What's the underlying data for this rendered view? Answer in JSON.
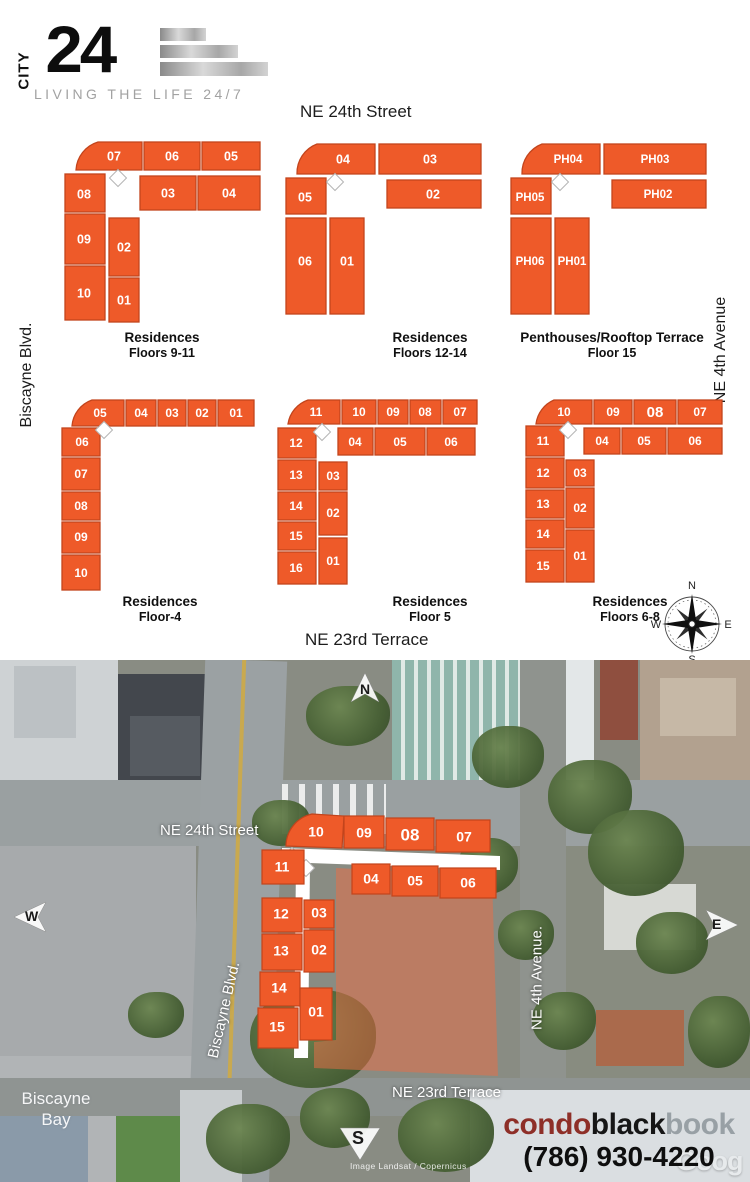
{
  "logo": {
    "vertical": "CITY",
    "number": "24",
    "tagline": "LIVING THE LIFE 24/7"
  },
  "streets": {
    "top": "NE 24th Street",
    "left": "Biscayne Blvd.",
    "right": "NE 4th Avenue",
    "bottom": "NE 23rd Terrace"
  },
  "plans": [
    {
      "title": "Residences",
      "subtitle": "Floors 9-11",
      "units": [
        "07",
        "06",
        "05",
        "08",
        "03",
        "04",
        "09",
        "02",
        "10",
        "01"
      ]
    },
    {
      "title": "Residences",
      "subtitle": "Floors 12-14",
      "units": [
        "04",
        "03",
        "05",
        "02",
        "06",
        "01"
      ]
    },
    {
      "title": "Penthouses/Rooftop Terrace",
      "subtitle": "Floor 15",
      "units": [
        "PH04",
        "PH03",
        "PH05",
        "PH02",
        "PH06",
        "PH01"
      ]
    },
    {
      "title": "Residences",
      "subtitle": "Floor-4",
      "units": [
        "05",
        "04",
        "03",
        "02",
        "01",
        "06",
        "07",
        "08",
        "09",
        "10"
      ]
    },
    {
      "title": "Residences",
      "subtitle": "Floor 5",
      "units": [
        "11",
        "10",
        "09",
        "08",
        "07",
        "12",
        "04",
        "05",
        "06",
        "13",
        "03",
        "14",
        "02",
        "15",
        "16",
        "01"
      ]
    },
    {
      "title": "Residences",
      "subtitle": "Floors 6-8",
      "units": [
        "10",
        "09",
        "08",
        "07",
        "11",
        "04",
        "05",
        "06",
        "12",
        "03",
        "13",
        "02",
        "14",
        "15",
        "01"
      ]
    }
  ],
  "compass_rose": {
    "n": "N",
    "e": "E",
    "s": "S",
    "w": "W"
  },
  "map": {
    "street_labels": {
      "ne24": "NE 24th Street",
      "biscayne": "Biscayne Blvd.",
      "ne4": "NE 4th Avenue.",
      "ne23": "NE 23rd Terrace",
      "bay_line1": "Biscayne",
      "bay_line2": "Bay"
    },
    "compass": {
      "n": "N",
      "w": "W",
      "e": "E",
      "s": "S"
    },
    "units": [
      "10",
      "09",
      "08",
      "07",
      "11",
      "04",
      "05",
      "06",
      "12",
      "03",
      "13",
      "02",
      "14",
      "15",
      "01"
    ],
    "attribution": "Image Landsat / Copernicus",
    "google_watermark": "Goog",
    "brand": {
      "part1": "condo",
      "part2": "black",
      "part3": "book",
      "phone": "(786) 930-4220"
    }
  },
  "colors": {
    "unit_fill": "#ee5a29",
    "unit_stroke": "#c2441c",
    "brand_red": "#8e2f28"
  }
}
